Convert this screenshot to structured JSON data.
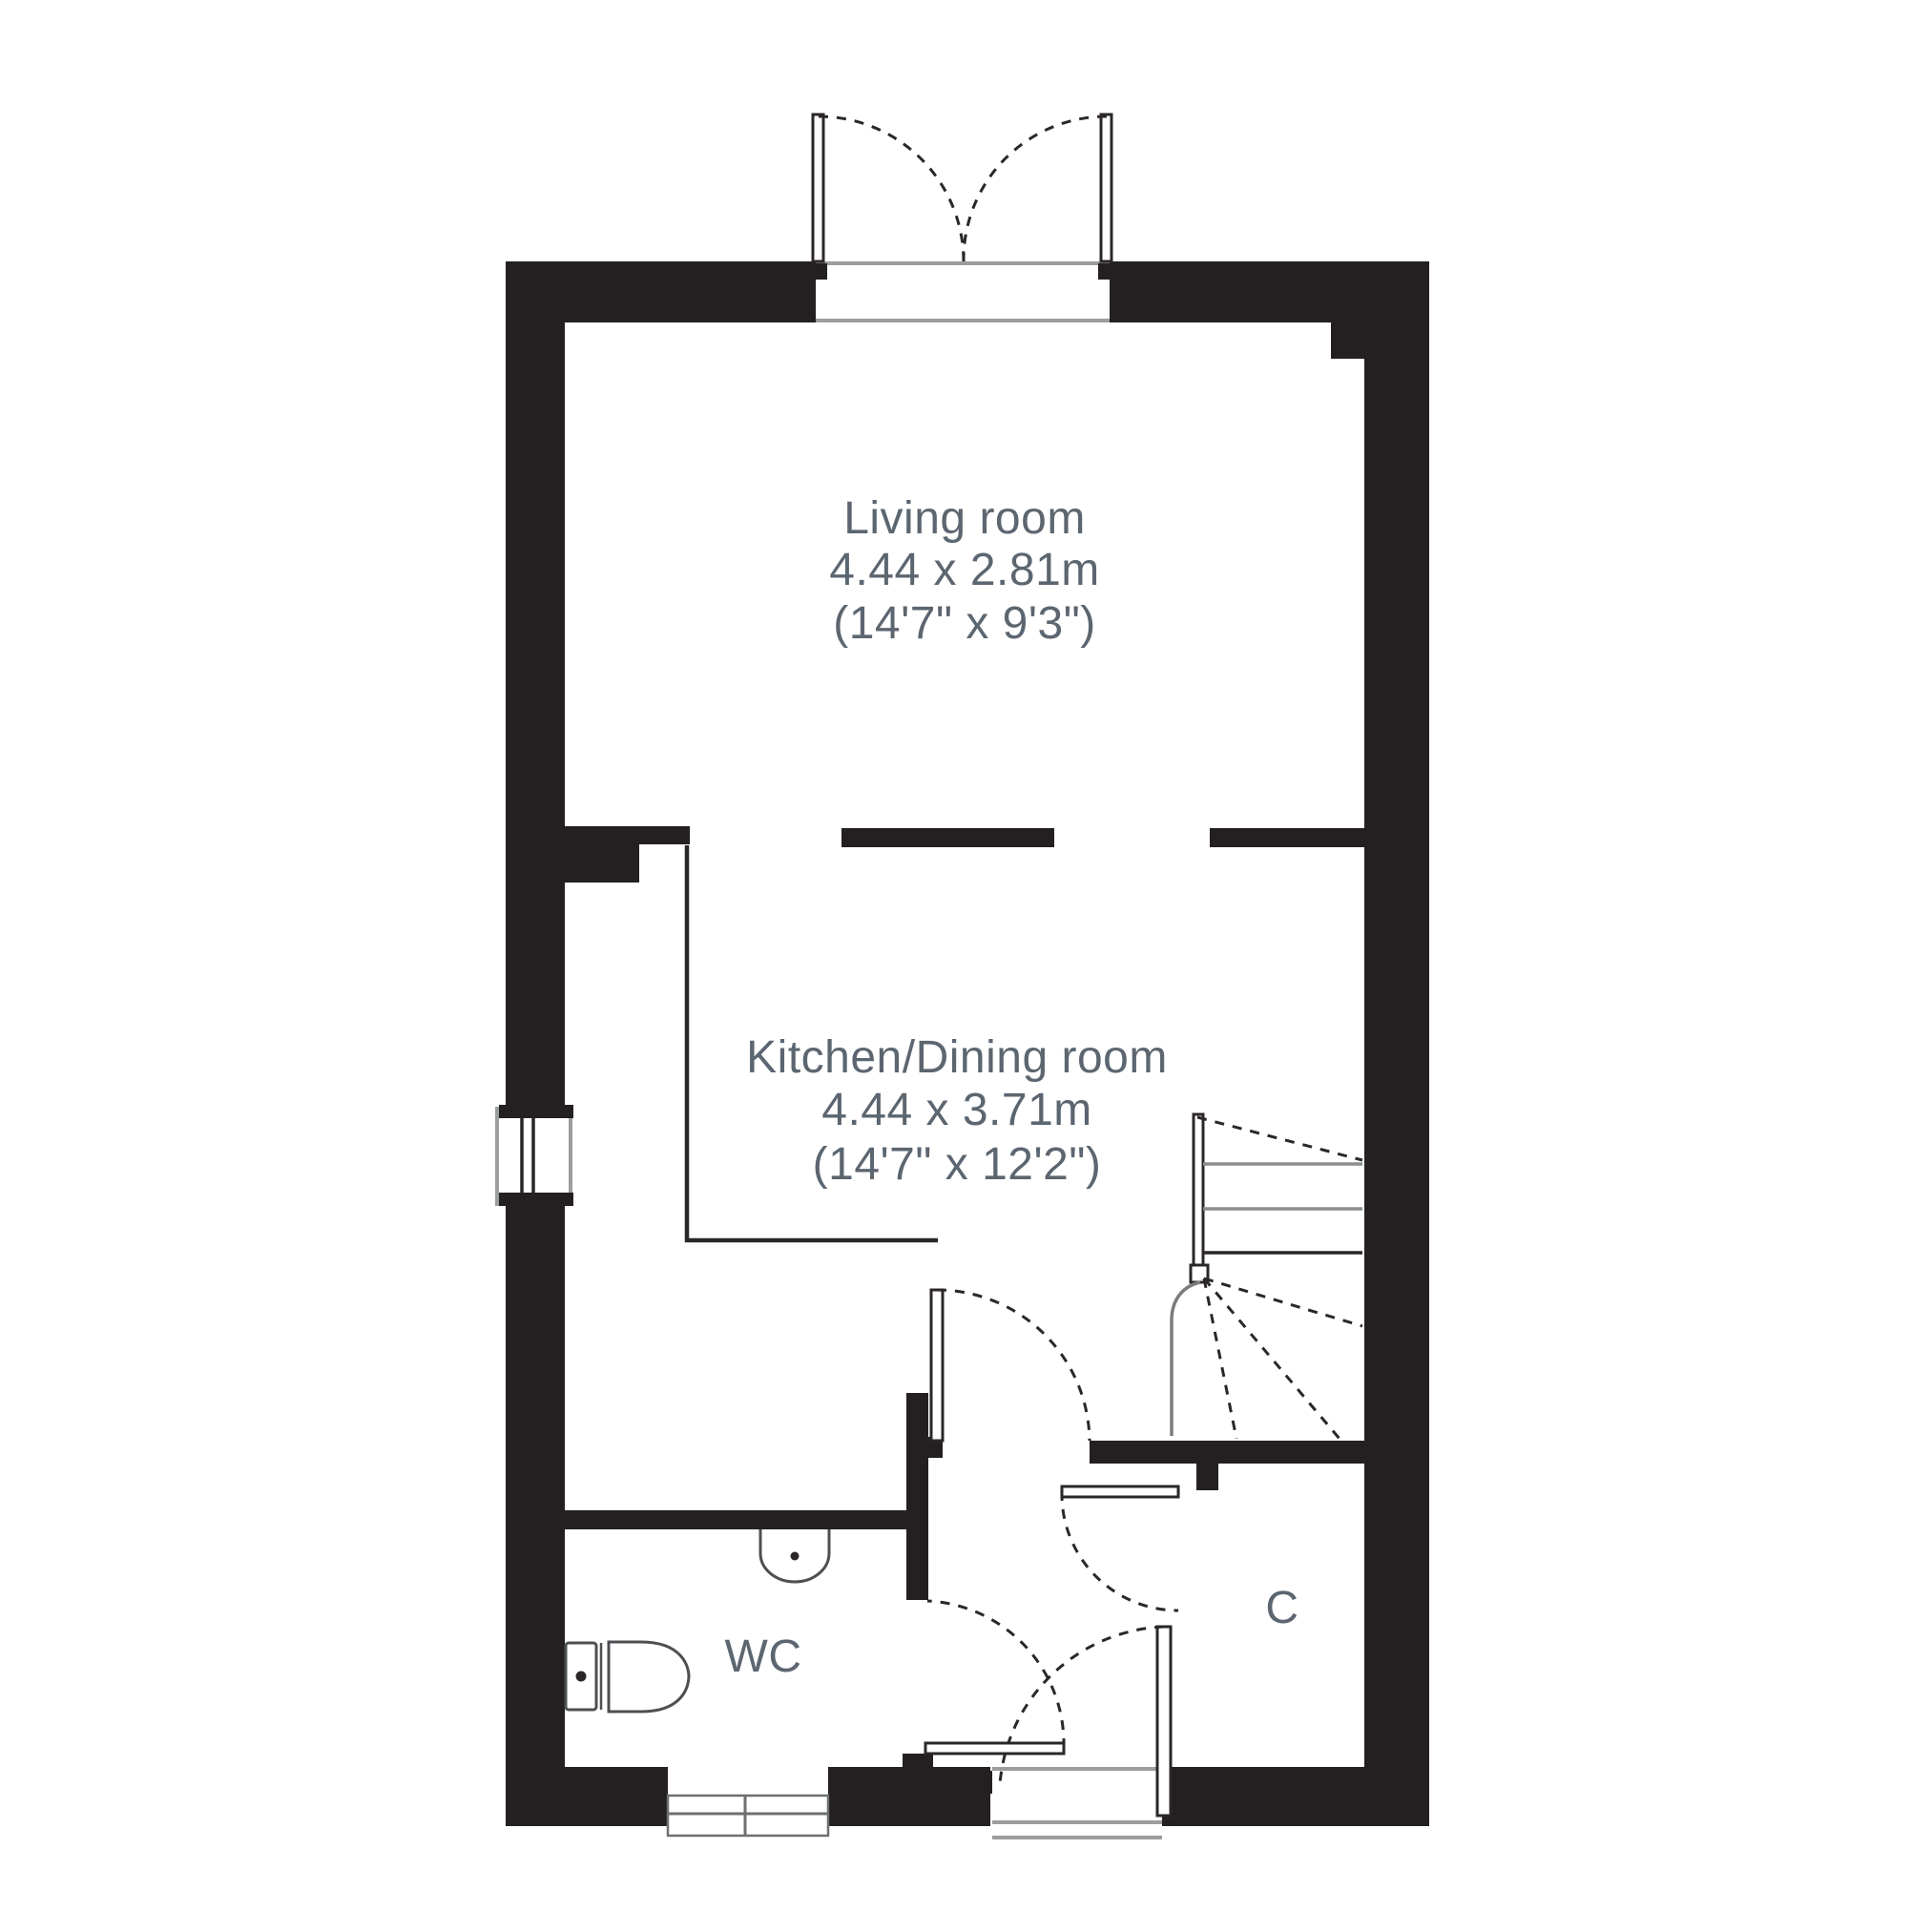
{
  "title": "Ground floor plan",
  "colors": {
    "wall": "#241f21",
    "line": "#2b2728",
    "gray_line": "#9b9da0",
    "label_text": "#5c6670",
    "background": "#ffffff"
  },
  "rooms": {
    "living": {
      "name": "Living room",
      "metric": "4.44 x 2.81m",
      "imperial": "(14'7\" x 9'3\")"
    },
    "kitchen": {
      "name": "Kitchen/Dining room",
      "metric": "4.44 x 3.71m",
      "imperial": "(14'7\" x 12'2\")"
    },
    "wc": {
      "label": "WC"
    },
    "cupboard": {
      "label": "C"
    }
  }
}
